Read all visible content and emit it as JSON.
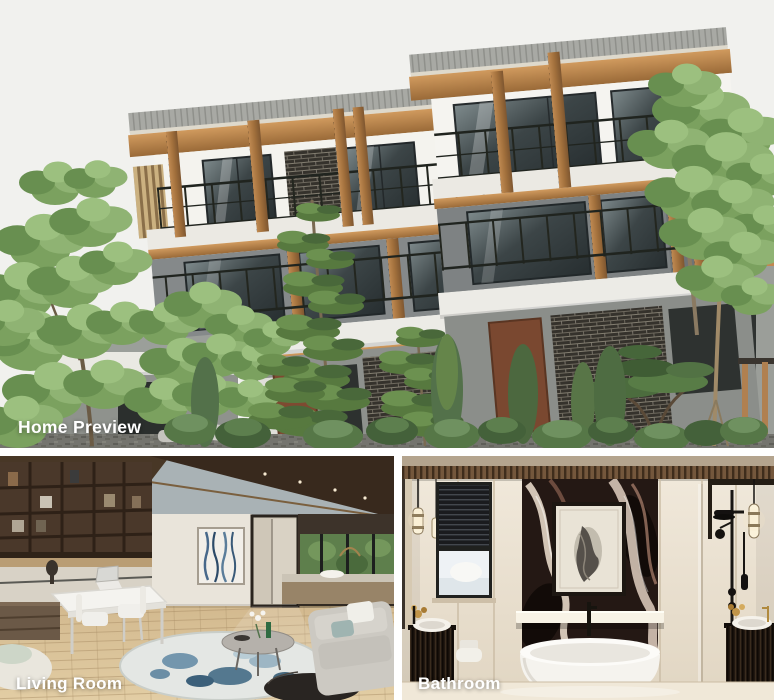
{
  "page": {
    "type": "property-photo-gallery",
    "background_color": "#ffffff"
  },
  "gallery": {
    "label_color": "#ffffff",
    "items": [
      {
        "id": "home-preview",
        "label": "Home Preview",
        "alt": "Exterior photo of a modern three-storey house with grey tiled roofs, wooden columns, glass balconies with black railings, surrounded by green trees and shrubs"
      },
      {
        "id": "living-room",
        "label": "Living Room",
        "alt": "Interior render of a living room with dark wood shelving, white desk and chairs, round blue patterned rug, coffee tables and a grey sofa"
      },
      {
        "id": "bathroom",
        "label": "Bathroom",
        "alt": "Interior render of a bathroom with a dark marble feature wall, framed artwork, freestanding white bathtub, black shower fixtures and fluted vanities"
      }
    ]
  },
  "palette": {
    "wood_accent": "#c28a52",
    "roof_grey": "#a8a9a4",
    "wall_white": "#f4f3ee",
    "wall_grey": "#84888a",
    "foliage_green": "#6d9150",
    "gravel_grey": "#73736d",
    "marble_dark": "#241814",
    "ceiling_brown": "#3a2c21",
    "floor_wood": "#d3bb92",
    "bathroom_cream": "#eae1d1",
    "label_text": "#ffffff",
    "gap": "#ffffff"
  }
}
